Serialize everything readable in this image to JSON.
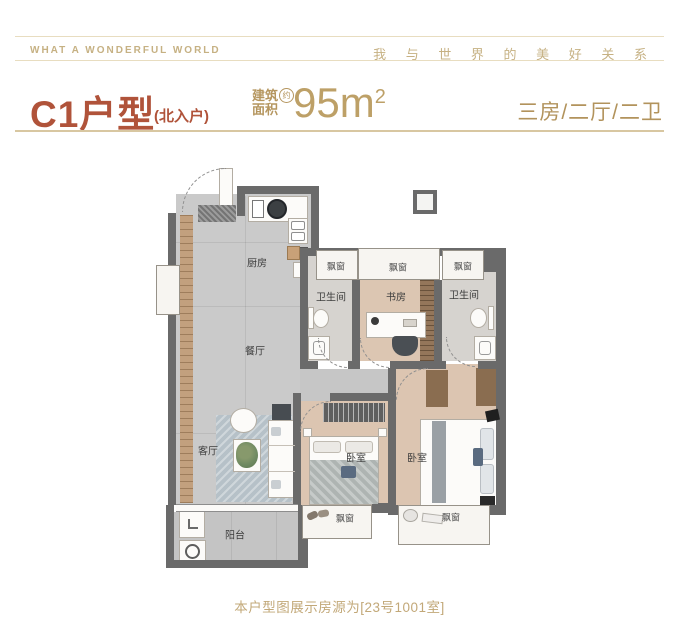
{
  "header": {
    "left": "WHAT A WONDERFUL WORLD",
    "right": "我 与 世 界 的 美 好 关 系"
  },
  "title": {
    "name": "C1户型",
    "entry_note": "(北入户)",
    "area_label_line1": "建筑",
    "area_label_line2": "面积",
    "area_approx": "约",
    "area_value": "95m",
    "area_exponent": "2",
    "rooms_summary": "三房/二厅/二卫"
  },
  "plan": {
    "labels": {
      "kitchen": "厨房",
      "dining": "餐厅",
      "living": "客厅",
      "balcony": "阳台",
      "study": "书房",
      "bath_left": "卫生间",
      "bath_right": "卫生间",
      "bedroom_left": "卧室",
      "bedroom_right": "卧室"
    },
    "bays": [
      "飘窗",
      "飘窗",
      "飘窗",
      "飘窗",
      "飘窗"
    ]
  },
  "footer": {
    "note": "本户型图展示房源为[23号1001室]"
  },
  "colors": {
    "accent_terracotta": "#b0533a",
    "accent_gold": "#b2935c",
    "wall_gray": "#6a6a6a",
    "floor_gray": "#cacaca",
    "floor_tan": "#dcc5b1"
  }
}
